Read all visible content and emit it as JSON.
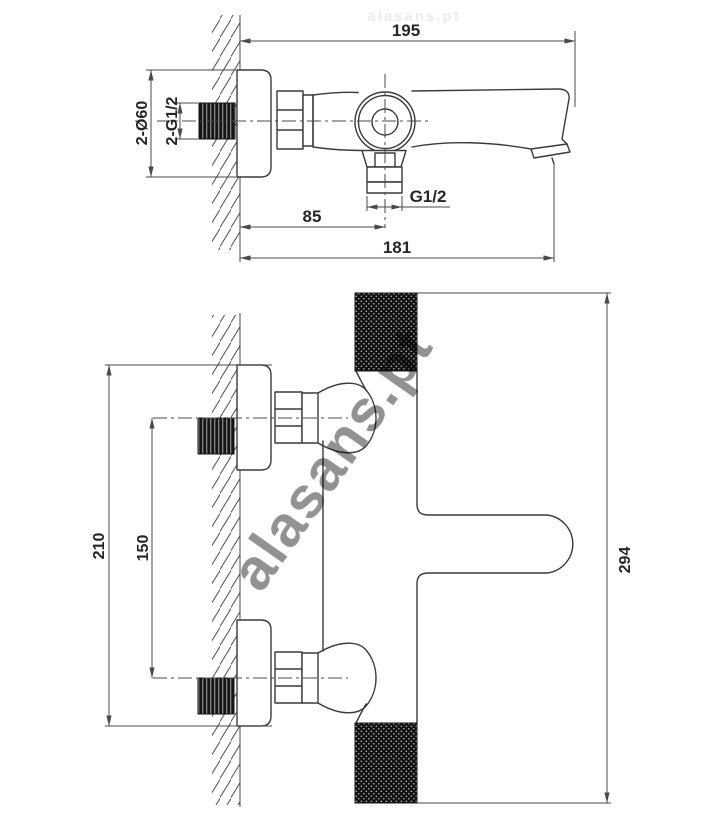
{
  "colors": {
    "outline": "#3a3a3a",
    "dimension": "#4a4a4a",
    "text": "#262626",
    "watermark": "#b5b5b5",
    "background": "#ffffff"
  },
  "watermark": {
    "text": "alasans.pt"
  },
  "side_view": {
    "dims": {
      "total_depth": "195",
      "escutcheons": "2-Ø60",
      "wall_connections": "2-G1/2",
      "outlet_thread": "G1/2",
      "outlet_offset": "85",
      "spout_reach": "181"
    }
  },
  "front_view": {
    "dims": {
      "escutcheon_span": "210",
      "connection_centers": "150",
      "overall_width": "294"
    }
  }
}
